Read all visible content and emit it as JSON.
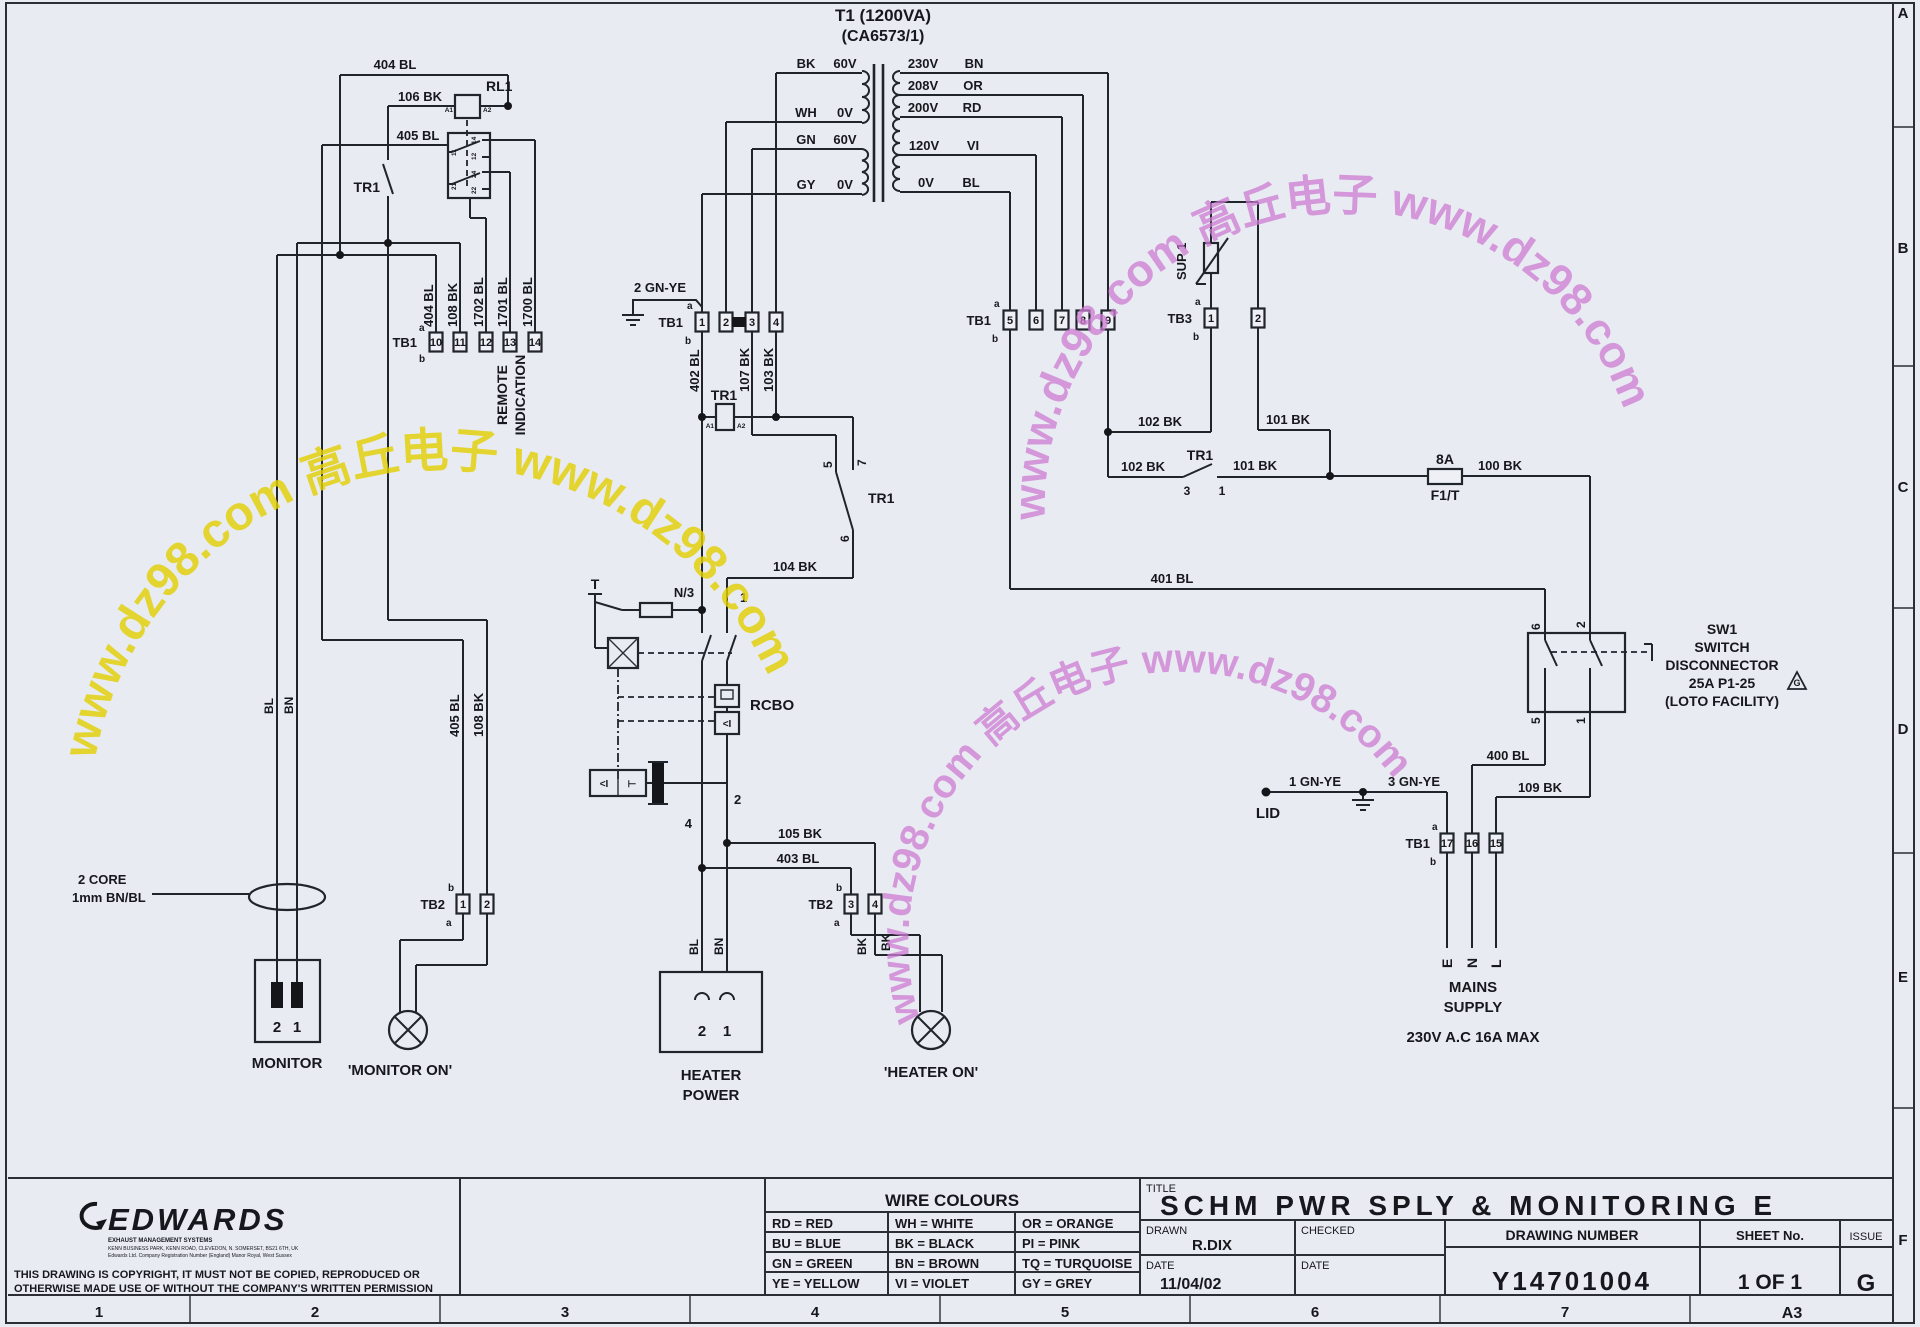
{
  "colors": {
    "paper": "#e8ebf1",
    "line": "#20242b",
    "watermark_yellow": "#e2cf06",
    "watermark_magenta": "#cd7bd3"
  },
  "watermark": {
    "text": "www.dz98.com 高丘电子 www.dz98.com"
  },
  "frame": {
    "r1": "A",
    "r2": "B",
    "r3": "C",
    "r4": "D",
    "r5": "E",
    "r6": "F",
    "c1": "1",
    "c2": "2",
    "c3": "3",
    "c4": "4",
    "c5": "5",
    "c6": "6",
    "c7": "7",
    "size": "A3"
  },
  "n": {
    "1": "1",
    "2": "2",
    "3": "3",
    "4": "4",
    "5": "5",
    "6": "6",
    "7": "7",
    "8": "8",
    "9": "9",
    "10": "10",
    "11": "11",
    "12": "12",
    "13": "13",
    "14": "14",
    "15": "15",
    "16": "16",
    "17": "17",
    "21": "21",
    "22": "22",
    "24": "24"
  },
  "tb": {
    "tb1": "TB1",
    "tb2": "TB2",
    "tb3": "TB3",
    "a": "a",
    "b": "b"
  },
  "t1": {
    "title": "T1 (1200VA)",
    "part": "(CA6573/1)",
    "bk": "BK",
    "wh": "WH",
    "gn": "GN",
    "gy": "GY",
    "v60": "60V",
    "v0": "0V",
    "v230": "230V",
    "v208": "208V",
    "v200": "200V",
    "v120": "120V",
    "bn": "BN",
    "or": "OR",
    "rd": "RD",
    "vi": "VI",
    "bl": "BL"
  },
  "w": {
    "100": "100 BK",
    "101": "101 BK",
    "102": "102 BK",
    "103": "103 BK",
    "104": "104 BK",
    "105": "105 BK",
    "106": "106 BK",
    "107": "107 BK",
    "108": "108 BK",
    "109": "109 BK",
    "400": "400 BL",
    "401": "401 BL",
    "402": "402 BL",
    "403": "403 BL",
    "404": "404 BL",
    "405": "405 BL",
    "1700": "1700 BL",
    "1701": "1701 BL",
    "1702": "1702 BL",
    "gnye1": "1 GN-YE",
    "gnye2": "2 GN-YE",
    "gnye3": "3 GN-YE",
    "bl": "BL",
    "bn": "BN",
    "bk": "BK"
  },
  "c": {
    "rl1": "RL1",
    "tr1": "TR1",
    "sup1": "SUP 1",
    "rcbo": "RCBO",
    "a1": "A1",
    "a2": "A2",
    "fuse": "8A",
    "fusename": "F1/T",
    "t": "T",
    "n3": "N/3",
    "lid": "LID",
    "remote1": "REMOTE",
    "remote2": "INDICATION",
    "monitor": "MONITOR",
    "monitoron": "'MONITOR ON'",
    "heateron": "'HEATER ON'",
    "heater1": "HEATER",
    "heater2": "POWER",
    "core1": "2 CORE",
    "core2": "1mm BN/BL",
    "sw1": "SW1",
    "sw2": "SWITCH",
    "sw3": "DISCONNECTOR",
    "sw4": "25A P1-25",
    "sw5": "(LOTO FACILITY)",
    "g": "G",
    "mains1": "MAINS",
    "mains2": "SUPPLY",
    "mains3": "230V A.C 16A MAX",
    "e": "E",
    "nn": "N",
    "l": "L"
  },
  "tblock": {
    "wire_colours_title": "WIRE COLOURS",
    "wc": [
      [
        "RD = RED",
        "WH = WHITE",
        "OR = ORANGE"
      ],
      [
        "BU = BLUE",
        "BK = BLACK",
        "PI = PINK"
      ],
      [
        "GN = GREEN",
        "BN = BROWN",
        "TQ = TURQUOISE"
      ],
      [
        "YE = YELLOW",
        "VI = VIOLET",
        "GY = GREY"
      ]
    ],
    "title_label": "TITLE",
    "title": "SCHM PWR SPLY & MONITORING E",
    "drawn_label": "DRAWN",
    "drawn": "R.DIX",
    "checked_label": "CHECKED",
    "date_label": "DATE",
    "date": "11/04/02",
    "date_label2": "DATE",
    "drawing_number_label": "DRAWING NUMBER",
    "drawing_number": "Y14701004",
    "sheet_label": "SHEET No.",
    "sheet": "1 OF 1",
    "issue_label": "ISSUE",
    "issue": "G",
    "brand": "EDWARDS",
    "brand_sub1": "EXHAUST MANAGEMENT SYSTEMS",
    "brand_sub2": "KENN BUSINESS PARK, KENN ROAD, CLEVEDON, N. SOMERSET, BS21 6TH, UK",
    "brand_sub3": "Edwards Ltd. Company Registration Number (England) Manor Royal, West Sussex",
    "copyright1": "THIS DRAWING IS COPYRIGHT, IT MUST NOT BE COPIED, REPRODUCED OR",
    "copyright2": "OTHERWISE MADE USE OF WITHOUT THE COMPANY'S WRITTEN PERMISSION"
  }
}
